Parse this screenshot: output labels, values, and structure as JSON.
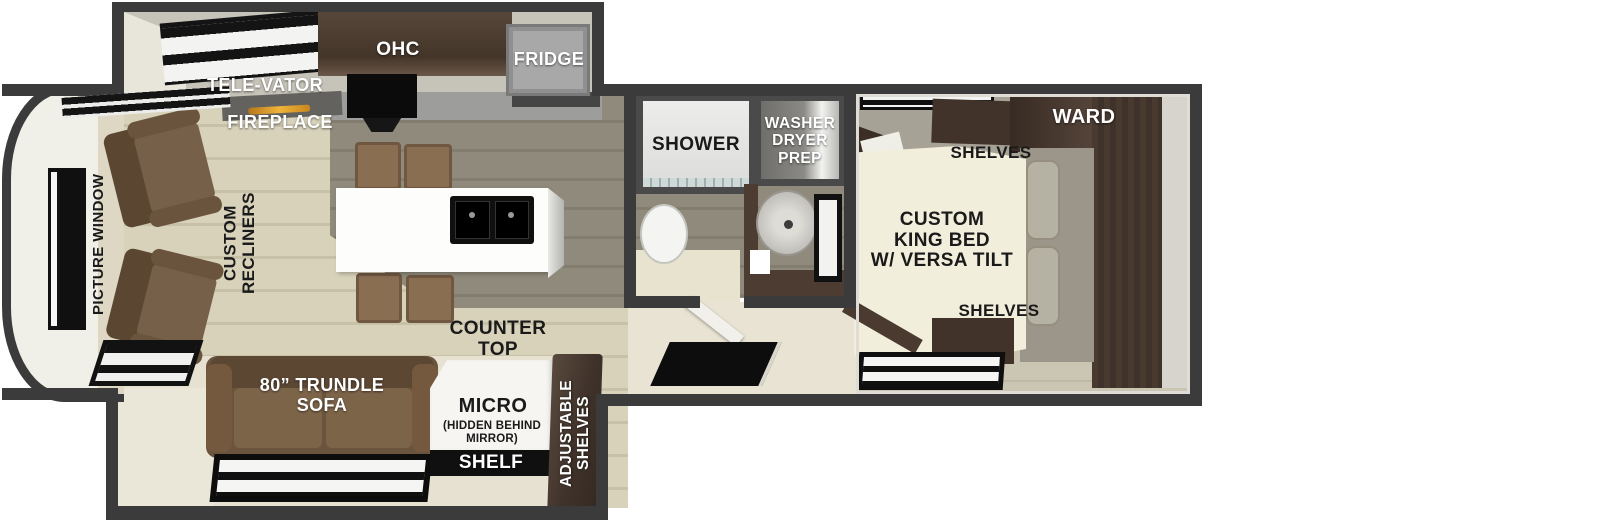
{
  "labels": {
    "ohc": "OHC",
    "fridge": "FRIDGE",
    "televator": "TELE-VATOR",
    "fireplace": "FIREPLACE",
    "picture_window": "PICTURE WINDOW",
    "custom_recliners": "CUSTOM\nRECLINERS",
    "counter_top": "COUNTER\nTOP",
    "trundle_sofa": "80” TRUNDLE\nSOFA",
    "micro": "MICRO",
    "micro_note": "(HIDDEN BEHIND\nMIRROR)",
    "shelf": "SHELF",
    "adjustable_shelves": "ADJUSTABLE\nSHELVES",
    "shower": "SHOWER",
    "washer_dryer_prep": "WASHER\nDRYER\nPREP",
    "ward": "WARD",
    "shelves_top": "SHELVES",
    "shelves_bottom": "SHELVES",
    "king_bed": "CUSTOM\nKING BED\nW/ VERSA TILT"
  },
  "colors": {
    "wall": "#3b3b3b",
    "floor_light": "#d8d2bb",
    "floor_olive": "#8f8a7b",
    "floor_bedroom": "#cbc5b3",
    "cabinet_dark_brown": "#41332a",
    "sofa_brown": "#6b543d",
    "island_white": "#fdfdfc",
    "fireplace_glow": "#e09a28",
    "label_white": "#ffffff",
    "label_black": "#1a1a1a"
  }
}
